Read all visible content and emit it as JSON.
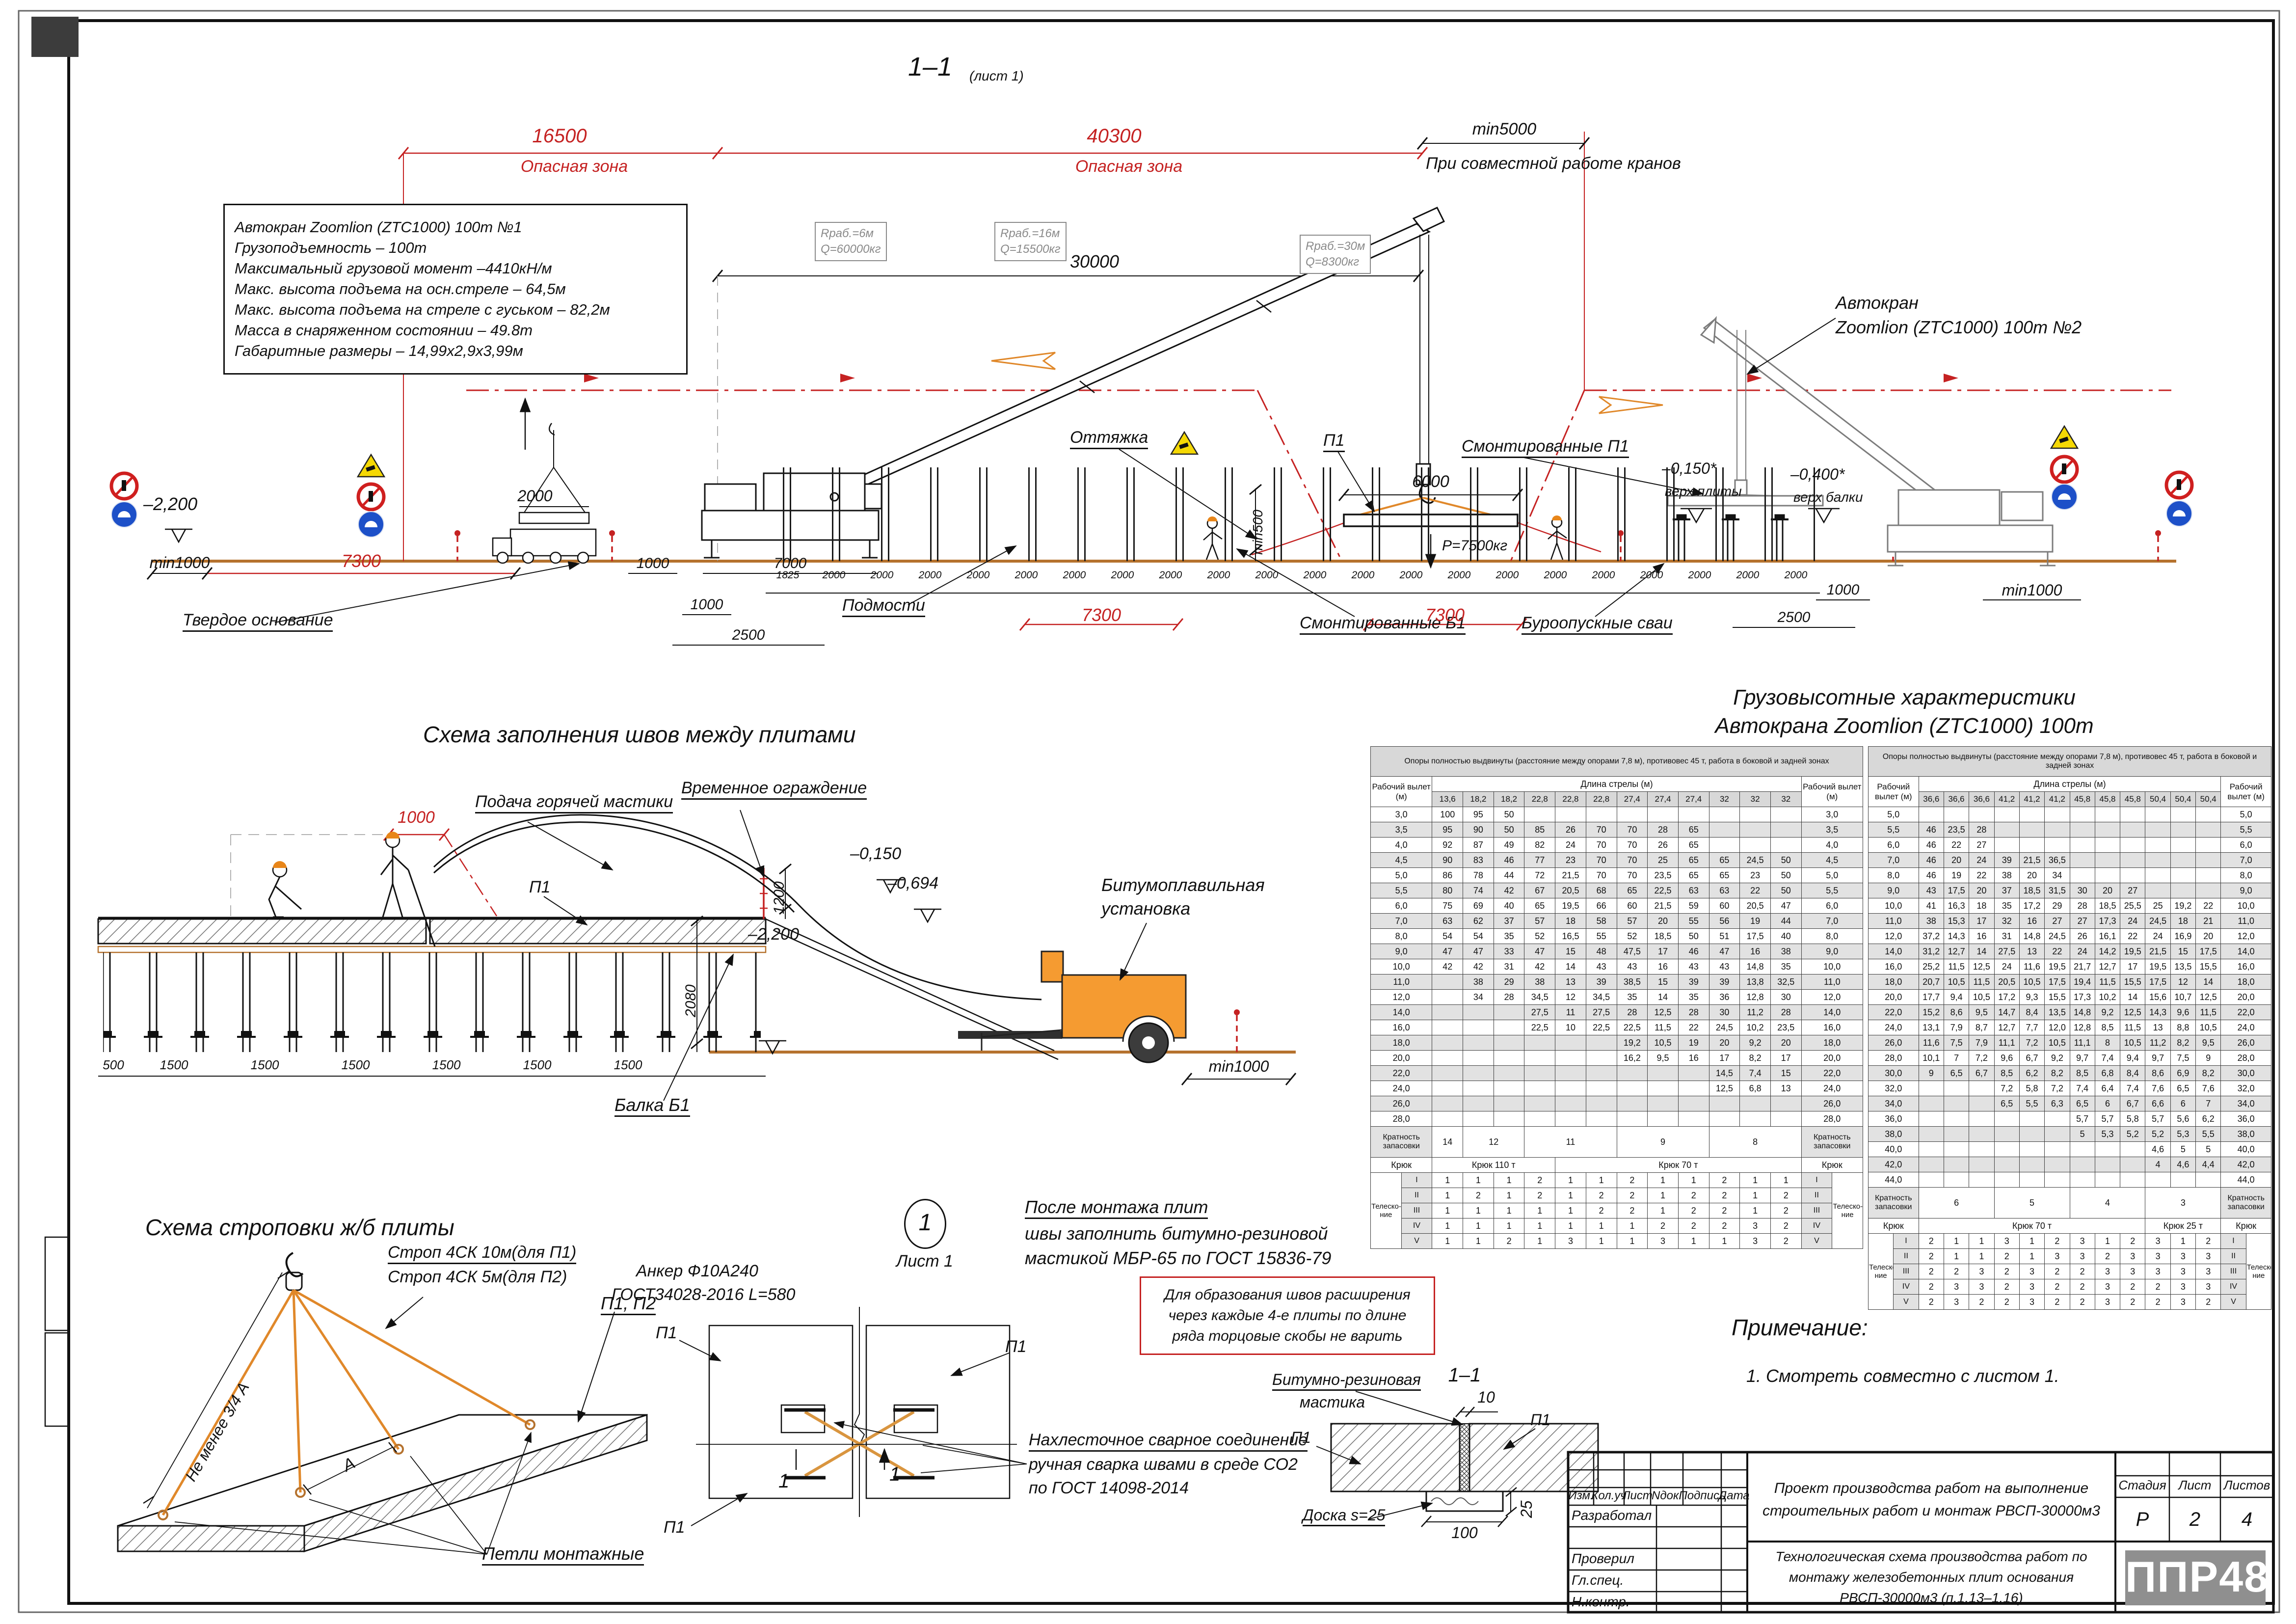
{
  "sheet": {
    "view_title": "1–1",
    "view_sheet_ref": "(лист 1)"
  },
  "section": {
    "danger1": {
      "dim": "16500",
      "label": "Опасная зона"
    },
    "danger2": {
      "dim": "40300",
      "label": "Опасная зона"
    },
    "min5000": "min5000",
    "joint_work_note": "При совместной работе кранов",
    "dim30000": "30000",
    "specs": [
      "Автокран Zoomlion (ZTC1000) 100т №1",
      "Грузоподъемность – 100т",
      "Максимальный грузовой момент –4410кН/м",
      "Макс. высота подъема на осн.стреле – 64,5м",
      "Макс. высота подъема на стреле с гуськом – 82,2м",
      "Масса в снаряженном состоянии – 49.8т",
      "Габаритные размеры – 14,99х2,9х3,99м"
    ],
    "callouts": [
      [
        "Rраб.=6м",
        "Q=60000кг"
      ],
      [
        "Rраб.=16м",
        "Q=15500кг"
      ],
      [
        "Rраб.=30м",
        "Q=8300кг"
      ]
    ],
    "crane2_label": [
      "Автокран",
      "Zoomlion (ZTC1000) 100т  №2"
    ],
    "guy": "Оттяжка",
    "p1": "П1",
    "dim6000": "6000",
    "load": "Р=7500кг",
    "min500": "min500",
    "mounted_p1": "Смонтированные П1",
    "lvl_minus0150": "–0,150*",
    "lvl_minus0150_sub": "верх плиты",
    "lvl_minus0400": "–0,400*",
    "lvl_minus0400_sub": "верх балки",
    "dim2000": "2000",
    "lvl_minus2200": "–2,200",
    "min1000_left": "min1000",
    "dim7300_left": "7300",
    "firm_base": "Твердое основание",
    "dim1000a": "1000",
    "dim7000": "7000",
    "dim1000b": "1000",
    "dim2500a": "2500",
    "scaffold": "Подмости",
    "mounted_b1": "Смонтированные Б1",
    "piles_label": "Буроопускные сваи",
    "dim2500r": "2500",
    "dim1000r": "1000",
    "min1000_right": "min1000",
    "dim7300a": "7300",
    "dim7300b": "7300",
    "chain": [
      "1825",
      "2000",
      "2000",
      "2000",
      "2000",
      "2000",
      "2000",
      "2000",
      "2000",
      "2000",
      "2000",
      "2000",
      "2000",
      "2000",
      "2000",
      "2000",
      "2000",
      "2000",
      "2000",
      "2000",
      "2000",
      "2000"
    ]
  },
  "joints": {
    "title": "Схема заполнения швов между плитами",
    "mastic_feed": "Подача горячей мастики",
    "fence": "Временное ограждение",
    "dim1000": "1000",
    "p1": "П1",
    "dim1200": "1200",
    "lvl_minus0150": "–0,150",
    "lvl_minus0694": "–0,694",
    "bitumen": [
      "Битумоплавильная",
      "установка"
    ],
    "dim2080": "2080",
    "lvl_minus2200": "–2,200",
    "min1000": "min1000",
    "beam": "Балка Б1",
    "chain": [
      "500",
      "1500",
      "1500",
      "1500",
      "1500",
      "1500",
      "1500"
    ]
  },
  "chars": {
    "title": [
      "Грузовысотные характеристики",
      "Автокрана Zoomlion (ZTC1000) 100т"
    ]
  },
  "table1": {
    "zone_note": "Опоры полностью выдвинуты (расстояние между опорами 7,8 м), противовес 45 т, работа в боковой и задней зонах",
    "reach_label": "Рабочий вылет",
    "unit": "(м)",
    "boom_label": "Длина стрелы (м)",
    "booms": [
      "13,6",
      "18,2",
      "18,2",
      "22,8",
      "22,8",
      "22,8",
      "27,4",
      "27,4",
      "27,4",
      "32",
      "32",
      "32"
    ],
    "rows": [
      [
        "3,0",
        [
          "100",
          "95",
          "50",
          "",
          "",
          "",
          "",
          "",
          "",
          "",
          "",
          ""
        ]
      ],
      [
        "3,5",
        [
          "95",
          "90",
          "50",
          "85",
          "26",
          "70",
          "70",
          "28",
          "65",
          "",
          "",
          ""
        ]
      ],
      [
        "4,0",
        [
          "92",
          "87",
          "49",
          "82",
          "24",
          "70",
          "70",
          "26",
          "65",
          "",
          "",
          ""
        ]
      ],
      [
        "4,5",
        [
          "90",
          "83",
          "46",
          "77",
          "23",
          "70",
          "70",
          "25",
          "65",
          "65",
          "24,5",
          "50"
        ]
      ],
      [
        "5,0",
        [
          "86",
          "78",
          "44",
          "72",
          "21,5",
          "70",
          "70",
          "23,5",
          "65",
          "65",
          "23",
          "50"
        ]
      ],
      [
        "5,5",
        [
          "80",
          "74",
          "42",
          "67",
          "20,5",
          "68",
          "65",
          "22,5",
          "63",
          "63",
          "22",
          "50"
        ]
      ],
      [
        "6,0",
        [
          "75",
          "69",
          "40",
          "65",
          "19,5",
          "66",
          "60",
          "21,5",
          "59",
          "60",
          "20,5",
          "47"
        ]
      ],
      [
        "7,0",
        [
          "63",
          "62",
          "37",
          "57",
          "18",
          "58",
          "57",
          "20",
          "55",
          "56",
          "19",
          "44"
        ]
      ],
      [
        "8,0",
        [
          "54",
          "54",
          "35",
          "52",
          "16,5",
          "55",
          "52",
          "18,5",
          "50",
          "51",
          "17,5",
          "40"
        ]
      ],
      [
        "9,0",
        [
          "47",
          "47",
          "33",
          "47",
          "15",
          "48",
          "47,5",
          "17",
          "46",
          "47",
          "16",
          "38"
        ]
      ],
      [
        "10,0",
        [
          "42",
          "42",
          "31",
          "42",
          "14",
          "43",
          "43",
          "16",
          "43",
          "43",
          "14,8",
          "35"
        ]
      ],
      [
        "11,0",
        [
          "",
          "38",
          "29",
          "38",
          "13",
          "39",
          "38,5",
          "15",
          "39",
          "39",
          "13,8",
          "32,5"
        ]
      ],
      [
        "12,0",
        [
          "",
          "34",
          "28",
          "34,5",
          "12",
          "34,5",
          "35",
          "14",
          "35",
          "36",
          "12,8",
          "30"
        ]
      ],
      [
        "14,0",
        [
          "",
          "",
          "",
          "27,5",
          "11",
          "27,5",
          "28",
          "12,5",
          "28",
          "30",
          "11,2",
          "28"
        ]
      ],
      [
        "16,0",
        [
          "",
          "",
          "",
          "22,5",
          "10",
          "22,5",
          "22,5",
          "11,5",
          "22",
          "24,5",
          "10,2",
          "23,5"
        ]
      ],
      [
        "18,0",
        [
          "",
          "",
          "",
          "",
          "",
          "",
          "19,2",
          "10,5",
          "19",
          "20",
          "9,2",
          "20"
        ]
      ],
      [
        "20,0",
        [
          "",
          "",
          "",
          "",
          "",
          "",
          "16,2",
          "9,5",
          "16",
          "17",
          "8,2",
          "17"
        ]
      ],
      [
        "22,0",
        [
          "",
          "",
          "",
          "",
          "",
          "",
          "",
          "",
          "",
          "14,5",
          "7,4",
          "15"
        ]
      ],
      [
        "24,0",
        [
          "",
          "",
          "",
          "",
          "",
          "",
          "",
          "",
          "",
          "12,5",
          "6,8",
          "13"
        ]
      ],
      [
        "26,0",
        [
          "",
          "",
          "",
          "",
          "",
          "",
          "",
          "",
          "",
          "",
          "",
          ""
        ]
      ],
      [
        "28,0",
        [
          "",
          "",
          "",
          "",
          "",
          "",
          "",
          "",
          "",
          "",
          "",
          ""
        ]
      ]
    ],
    "mult_label": "Кратность запасовки",
    "mult": [
      {
        "t": "14",
        "c": 1
      },
      {
        "t": "12",
        "c": 2
      },
      {
        "t": "11",
        "c": 3
      },
      {
        "t": "9",
        "c": 3
      },
      {
        "t": "8",
        "c": 3
      }
    ],
    "hook_label": "Крюк",
    "hooks": [
      {
        "t": "Крюк 110 т",
        "c": 4
      },
      {
        "t": "Крюк 70 т",
        "c": 8
      }
    ],
    "tele_label": "Телеско-ние",
    "tele": [
      [
        "I",
        [
          "1",
          "1",
          "1",
          "2",
          "1",
          "1",
          "2",
          "1",
          "1",
          "2",
          "1",
          "1"
        ]
      ],
      [
        "II",
        [
          "1",
          "2",
          "1",
          "2",
          "1",
          "2",
          "2",
          "1",
          "2",
          "2",
          "1",
          "2"
        ]
      ],
      [
        "III",
        [
          "1",
          "1",
          "1",
          "1",
          "1",
          "2",
          "2",
          "1",
          "2",
          "2",
          "1",
          "2"
        ]
      ],
      [
        "IV",
        [
          "1",
          "1",
          "1",
          "1",
          "1",
          "1",
          "1",
          "2",
          "2",
          "2",
          "3",
          "2"
        ]
      ],
      [
        "V",
        [
          "1",
          "1",
          "2",
          "1",
          "3",
          "1",
          "1",
          "3",
          "1",
          "1",
          "3",
          "2"
        ]
      ]
    ]
  },
  "table2": {
    "zone_note": "Опоры полностью выдвинуты (расстояние между опорами 7,8 м), противовес 45 т, работа в боковой и задней зонах",
    "reach_label": "Рабочий вылет",
    "unit": "(м)",
    "boom_label": "Длина стрелы (м)",
    "booms": [
      "36,6",
      "36,6",
      "36,6",
      "41,2",
      "41,2",
      "41,2",
      "45,8",
      "45,8",
      "45,8",
      "50,4",
      "50,4",
      "50,4"
    ],
    "rows": [
      [
        "5,0",
        [
          "",
          "",
          "",
          "",
          "",
          "",
          "",
          "",
          "",
          "",
          "",
          ""
        ]
      ],
      [
        "5,5",
        [
          "46",
          "23,5",
          "28",
          "",
          "",
          "",
          "",
          "",
          "",
          "",
          "",
          ""
        ]
      ],
      [
        "6,0",
        [
          "46",
          "22",
          "27",
          "",
          "",
          "",
          "",
          "",
          "",
          "",
          "",
          ""
        ]
      ],
      [
        "7,0",
        [
          "46",
          "20",
          "24",
          "39",
          "21,5",
          "36,5",
          "",
          "",
          "",
          "",
          "",
          ""
        ]
      ],
      [
        "8,0",
        [
          "46",
          "19",
          "22",
          "38",
          "20",
          "34",
          "",
          "",
          "",
          "",
          "",
          ""
        ]
      ],
      [
        "9,0",
        [
          "43",
          "17,5",
          "20",
          "37",
          "18,5",
          "31,5",
          "30",
          "20",
          "27",
          "",
          "",
          ""
        ]
      ],
      [
        "10,0",
        [
          "41",
          "16,3",
          "18",
          "35",
          "17,2",
          "29",
          "28",
          "18,5",
          "25,5",
          "25",
          "19,2",
          "22"
        ]
      ],
      [
        "11,0",
        [
          "38",
          "15,3",
          "17",
          "32",
          "16",
          "27",
          "27",
          "17,3",
          "24",
          "24,5",
          "18",
          "21"
        ]
      ],
      [
        "12,0",
        [
          "37,2",
          "14,3",
          "16",
          "31",
          "14,8",
          "24,5",
          "26",
          "16,1",
          "22",
          "24",
          "16,9",
          "20"
        ]
      ],
      [
        "14,0",
        [
          "31,2",
          "12,7",
          "14",
          "27,5",
          "13",
          "22",
          "24",
          "14,2",
          "19,5",
          "21,5",
          "15",
          "17,5"
        ]
      ],
      [
        "16,0",
        [
          "25,2",
          "11,5",
          "12,5",
          "24",
          "11,6",
          "19,5",
          "21,7",
          "12,7",
          "17",
          "19,5",
          "13,5",
          "15,5"
        ]
      ],
      [
        "18,0",
        [
          "20,7",
          "10,5",
          "11,5",
          "20,5",
          "10,5",
          "17,5",
          "19,4",
          "11,5",
          "15,5",
          "17,5",
          "12",
          "14"
        ]
      ],
      [
        "20,0",
        [
          "17,7",
          "9,4",
          "10,5",
          "17,2",
          "9,3",
          "15,5",
          "17,3",
          "10,2",
          "14",
          "15,6",
          "10,7",
          "12,5"
        ]
      ],
      [
        "22,0",
        [
          "15,2",
          "8,6",
          "9,5",
          "14,7",
          "8,4",
          "13,5",
          "14,8",
          "9,2",
          "12,5",
          "14,3",
          "9,6",
          "11,5"
        ]
      ],
      [
        "24,0",
        [
          "13,1",
          "7,9",
          "8,7",
          "12,7",
          "7,7",
          "12,0",
          "12,8",
          "8,5",
          "11,5",
          "13",
          "8,8",
          "10,5"
        ]
      ],
      [
        "26,0",
        [
          "11,6",
          "7,5",
          "7,9",
          "11,1",
          "7,2",
          "10,5",
          "11,1",
          "8",
          "10,5",
          "11,2",
          "8,2",
          "9,5"
        ]
      ],
      [
        "28,0",
        [
          "10,1",
          "7",
          "7,2",
          "9,6",
          "6,7",
          "9,2",
          "9,7",
          "7,4",
          "9,4",
          "9,7",
          "7,5",
          "9"
        ]
      ],
      [
        "30,0",
        [
          "9",
          "6,5",
          "6,7",
          "8,5",
          "6,2",
          "8,2",
          "8,5",
          "6,8",
          "8,4",
          "8,6",
          "6,9",
          "8,2"
        ]
      ],
      [
        "32,0",
        [
          "",
          "",
          "",
          "7,2",
          "5,8",
          "7,2",
          "7,4",
          "6,4",
          "7,4",
          "7,6",
          "6,5",
          "7,6"
        ]
      ],
      [
        "34,0",
        [
          "",
          "",
          "",
          "6,5",
          "5,5",
          "6,3",
          "6,5",
          "6",
          "6,7",
          "6,6",
          "6",
          "7"
        ]
      ],
      [
        "36,0",
        [
          "",
          "",
          "",
          "",
          "",
          "",
          "5,7",
          "5,7",
          "5,8",
          "5,7",
          "5,6",
          "6,2"
        ]
      ],
      [
        "38,0",
        [
          "",
          "",
          "",
          "",
          "",
          "",
          "5",
          "5,3",
          "5,2",
          "5,2",
          "5,3",
          "5,5"
        ]
      ],
      [
        "40,0",
        [
          "",
          "",
          "",
          "",
          "",
          "",
          "",
          "",
          "",
          "4,6",
          "5",
          "5"
        ]
      ],
      [
        "42,0",
        [
          "",
          "",
          "",
          "",
          "",
          "",
          "",
          "",
          "",
          "4",
          "4,6",
          "4,4"
        ]
      ],
      [
        "44,0",
        [
          "",
          "",
          "",
          "",
          "",
          "",
          "",
          "",
          "",
          "",
          "",
          ""
        ]
      ]
    ],
    "mult_label": "Кратность запасовки",
    "mult": [
      {
        "t": "6",
        "c": 3
      },
      {
        "t": "5",
        "c": 3
      },
      {
        "t": "4",
        "c": 3
      },
      {
        "t": "3",
        "c": 3
      }
    ],
    "hook_label": "Крюк",
    "hooks": [
      {
        "t": "Крюк 70 т",
        "c": 9
      },
      {
        "t": "Крюк 25 т",
        "c": 3
      }
    ],
    "tele_label": "Телеско-ние",
    "tele": [
      [
        "I",
        [
          "2",
          "1",
          "1",
          "3",
          "1",
          "2",
          "3",
          "1",
          "2",
          "3",
          "1",
          "2"
        ]
      ],
      [
        "II",
        [
          "2",
          "1",
          "1",
          "2",
          "1",
          "3",
          "3",
          "2",
          "3",
          "3",
          "3",
          "3"
        ]
      ],
      [
        "III",
        [
          "2",
          "2",
          "3",
          "2",
          "3",
          "2",
          "2",
          "3",
          "3",
          "3",
          "3",
          "3"
        ]
      ],
      [
        "IV",
        [
          "2",
          "3",
          "3",
          "2",
          "3",
          "2",
          "2",
          "3",
          "2",
          "2",
          "3",
          "3"
        ]
      ],
      [
        "V",
        [
          "2",
          "3",
          "2",
          "2",
          "3",
          "2",
          "2",
          "3",
          "2",
          "2",
          "3",
          "2"
        ]
      ]
    ]
  },
  "slings": {
    "title": "Схема строповки ж/б плиты",
    "sling1": "Строп 4СК 10м(для П1)",
    "sling2": "Строп 4СК 5м(для П2)",
    "plates": "П1, П2",
    "min_three_quarters": "Не менее 3/4 А",
    "a_dim": "А",
    "loops": "Петли монтажные"
  },
  "detail": {
    "num": "1",
    "sheet_ref": "Лист 1",
    "note_mastic": [
      "После монтажа плит",
      "швы заполнить битумно-резиновой",
      "мастикой МБР-65 по ГОСТ 15836-79"
    ],
    "anchor": [
      "Анкер Ф10А240",
      "ГОСТ34028-2016 L=580"
    ],
    "warn": [
      "Для образования швов расширения",
      "через каждые 4-е плиты по длине",
      "ряда торцовые скобы не варить"
    ],
    "weld": [
      "Нахлесточное сварное соединение",
      "ручная сварка швами в среде СО2",
      "по ГОСТ 14098-2014"
    ],
    "p1": "П1",
    "cut": "1"
  },
  "detail11": {
    "title": "1–1",
    "mastic": [
      "Битумно-резиновая",
      "мастика"
    ],
    "p1": "П1",
    "dim10": "10",
    "board": "Доска s=25",
    "dim100": "100",
    "dim25": "25"
  },
  "notes": {
    "title": "Примечание:",
    "item1": "1.    Смотреть совместно с листом 1."
  },
  "titleblock": {
    "cols": [
      "Изм.",
      "Кол.уч",
      "Лист",
      "Nдок.",
      "Подпись",
      "Дата"
    ],
    "roles": [
      "Разработал",
      "",
      "Проверил",
      "Гл.спец.",
      "Н.контр."
    ],
    "doc_title": [
      "Проект производства работ на выполнение",
      "строительных работ и монтаж РВСП-30000м3"
    ],
    "stage_label": "Стадия",
    "sheet_label": "Лист",
    "sheets_label": "Листов",
    "stage": "Р",
    "sheet_no": "2",
    "sheets_total": "4",
    "sub_title": [
      "Технологическая схема производства работ по",
      "монтажу железобетонных плит основания",
      "РВСП-30000м3  (п.1.13–1.16)"
    ],
    "logo": "ППР48"
  }
}
